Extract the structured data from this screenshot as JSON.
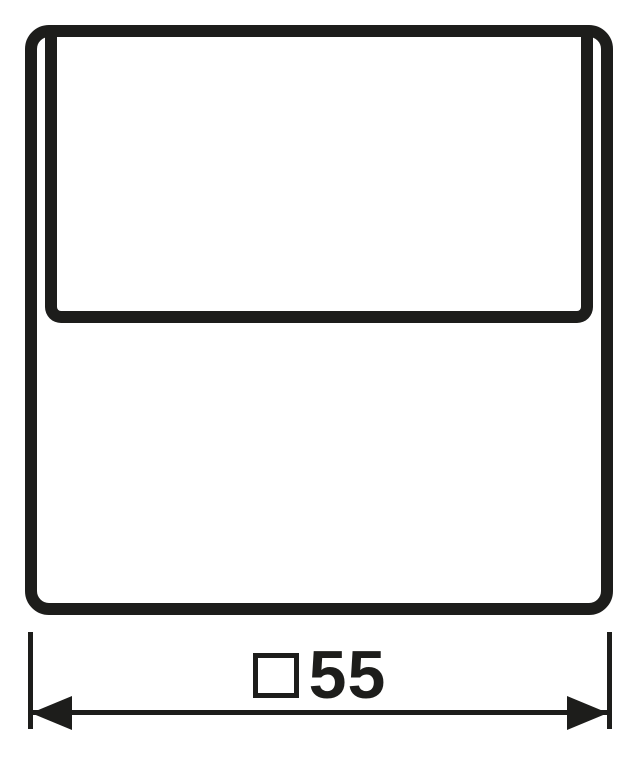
{
  "drawing": {
    "description": "Technical line drawing, front view of a square cover plate with flip lid",
    "line_color": "#1d1d1b",
    "background_color": "#ffffff"
  },
  "dimension": {
    "symbol": "square-outline",
    "value": "55",
    "full_label": "□55"
  }
}
